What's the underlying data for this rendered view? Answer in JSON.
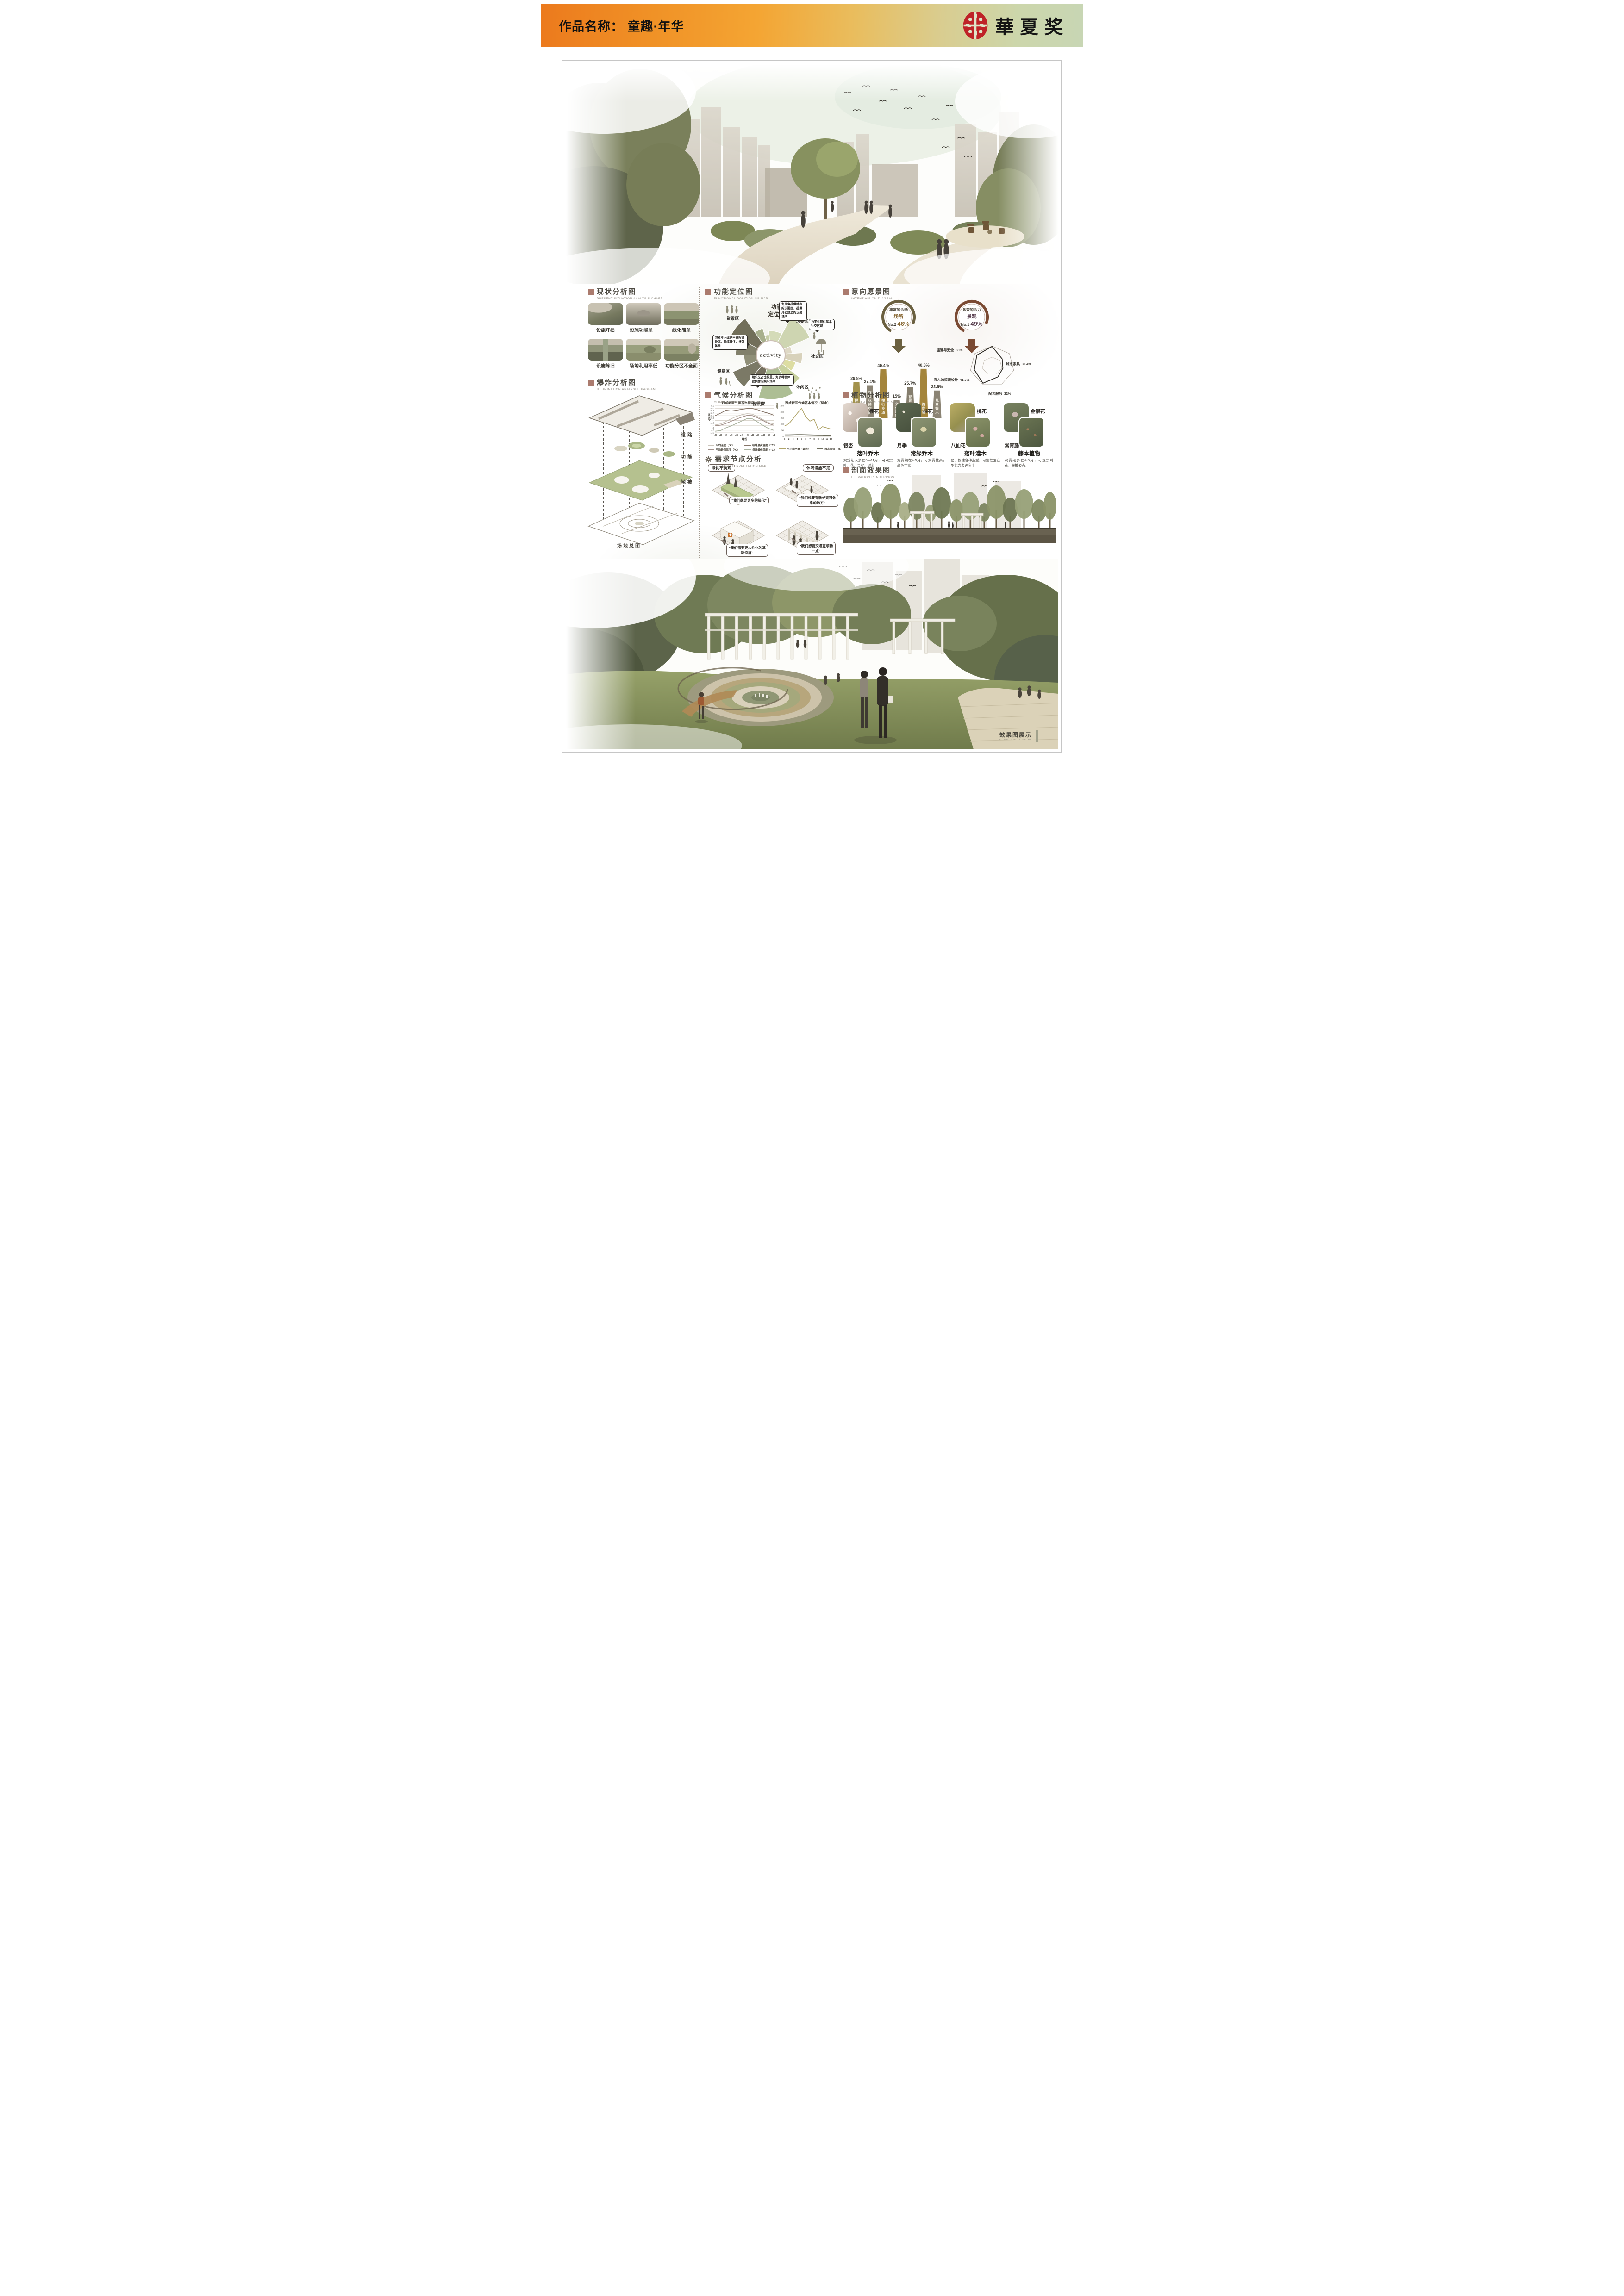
{
  "header": {
    "title": "作品名称： 童趣·年华",
    "award": "華夏奖"
  },
  "sections": {
    "present": {
      "title": "现状分析图",
      "subtitle": "PRESENT SITUATION ANALYSIS CHART",
      "photos": [
        {
          "caption": "设施坏损"
        },
        {
          "caption": "设施功能单一"
        },
        {
          "caption": "绿化简单"
        },
        {
          "caption": "设施陈旧"
        },
        {
          "caption": "场地利用率低"
        },
        {
          "caption": "功能分区不全面"
        }
      ]
    },
    "explosion": {
      "title": "爆炸分析图",
      "subtitle": "ILLUMINATION ANALYSIS DIAGRAM",
      "layers": [
        "道路",
        "功能",
        "地被"
      ],
      "base_label": "场地总图"
    },
    "functional": {
      "title": "功能定位图",
      "subtitle": "FUNCTIONAL POSITIONING MAP",
      "center_word": "activity",
      "center_title_line1": "功能",
      "center_title_line2": "定位图",
      "zones": [
        "赏景区",
        "玩耍区",
        "社交区",
        "休闲区",
        "娱乐区",
        "健身区"
      ],
      "bubbles": [
        "为儿童提供特有的玩耍区，提供开心舒适的玩耍场所",
        "为学生提供基本社交区域",
        "为老年人提供单独的健身区，锻炼身体，增强体质",
        "娱乐区占比较重，为多种群体提供休闲娱乐场所"
      ]
    },
    "climate": {
      "title": "气候分析图",
      "subtitle": "CLIMATIC ANALYSIS CHART"
    },
    "demand": {
      "title": "需求节点分析",
      "subtitle": "THEME INTERPRETATION MAP",
      "items": [
        {
          "label": "绿化不美观",
          "quote": "“我们想要更多的绿化”",
          "type": "planter"
        },
        {
          "label": "休闲设施不足",
          "quote": "“我们想要有散步完可休息的地方”",
          "type": "bench"
        },
        {
          "label": "",
          "quote": "“我们需要更人性化的基础设施”",
          "type": "kiosk"
        },
        {
          "label": "",
          "quote": "“我们想要交通更顺畅一点”",
          "type": "pergola"
        }
      ]
    },
    "intent": {
      "title": "意向愿景图",
      "subtitle": "INTENT VISION DIAGRAM",
      "circles": [
        {
          "line1": "丰富的活动",
          "line2": "场所",
          "rank": "No.2",
          "pct": "46%"
        },
        {
          "line1": "多变的活力",
          "line2": "景观",
          "rank": "No.1",
          "pct": "49%"
        }
      ]
    },
    "plants": {
      "title": "植物分析图",
      "subtitle": "PLANT ANALYSIS DIAGRAM",
      "columns": [
        {
          "top": "樱花",
          "bottom": "银杏",
          "category": "落叶乔木",
          "desc": "观赏期大多在5—11月，可观赏叶，花，果实，树姿"
        },
        {
          "top": "桂花",
          "bottom": "月季",
          "category": "常绿乔木",
          "desc": "观赏期在4-5月，可观赏性高，颜色丰富"
        },
        {
          "top": "桃花",
          "bottom": "八仙花",
          "category": "落叶灌木",
          "desc": "易于修建各种造型，可塑性强造型能力表达突出"
        },
        {
          "top": "金银花",
          "bottom": "常青藤",
          "category": "藤本植物",
          "desc": "观赏期多在4-8月，可观赏叶花，攀援姿态。"
        }
      ]
    },
    "elevation": {
      "title": "剖面效果图",
      "subtitle": "ELEVATION RENDERINGS"
    },
    "show": {
      "title": "效果图展示",
      "subtitle": "RENDERINGS SHOW"
    }
  },
  "chart_data": [
    {
      "type": "line",
      "title": "西咸新区气候基本情况（温度）",
      "xlabel": "月份",
      "ylabel": "温度℃",
      "x": [
        "1月",
        "2月",
        "3月",
        "4月",
        "5月",
        "6月",
        "7月",
        "8月",
        "9月",
        "10月",
        "11月",
        "12月"
      ],
      "ylim": [
        -10,
        45
      ],
      "ystep": 5,
      "grid": true,
      "legend_position": "bottom",
      "series": [
        {
          "name": "平均温度（℃）",
          "color": "#cbc5bb",
          "values": [
            6,
            8,
            13,
            18.5,
            23.5,
            27,
            29,
            28,
            23,
            17,
            11,
            8
          ]
        },
        {
          "name": "极端最高温度（℃）",
          "color": "#857468",
          "values": [
            25,
            30,
            36,
            34.5,
            36,
            38,
            39.5,
            39.5,
            37,
            33,
            30,
            26
          ]
        },
        {
          "name": "平均最低温度（℃）",
          "color": "#a2908a",
          "values": [
            4,
            5.5,
            9,
            13.5,
            18,
            22,
            25.5,
            25,
            20.5,
            15,
            9,
            5.5
          ]
        },
        {
          "name": "极端最低温度（℃）",
          "color": "#a9b29f",
          "values": [
            -7,
            -5.5,
            0,
            4,
            9,
            14,
            19,
            18.5,
            12,
            5,
            -1,
            -5
          ]
        }
      ]
    },
    {
      "type": "line",
      "title": "西咸新区气候基本情况（降水）",
      "x": [
        "1",
        "2",
        "3",
        "4",
        "5",
        "6",
        "7",
        "8",
        "9",
        "10",
        "11",
        "12"
      ],
      "ylim": [
        0,
        250
      ],
      "ystep": 50,
      "grid": false,
      "legend_position": "bottom",
      "series": [
        {
          "name": "平均降水量（毫米）",
          "color": "#b0a469",
          "values": [
            85,
            105,
            145,
            190,
            230,
            160,
            125,
            140,
            55,
            80,
            70,
            60
          ]
        },
        {
          "name": "降水天数（日）",
          "color": "#6e6e5e",
          "values": [
            13,
            13,
            14,
            15,
            15,
            14,
            13,
            12,
            11,
            11,
            10,
            10
          ]
        }
      ]
    },
    {
      "type": "bar",
      "title": "意向愿景活动需求占比",
      "unit": "%",
      "categories": [
        "健身运动",
        "开敞休憩空间",
        "慢行步道",
        "文化场所",
        "观景停留点",
        "跑步道",
        "儿童娱乐"
      ],
      "values": [
        29.8,
        27.1,
        40.4,
        15,
        25.7,
        40.8,
        22.8
      ],
      "colors": [
        "#a3924c",
        "#8b8474",
        "#a4853c",
        "#8b8474",
        "#857e6e",
        "#a4853c",
        "#8b8474"
      ]
    },
    {
      "type": "radar",
      "shape": "heptagon",
      "unit": "%",
      "axes_labeled": [
        {
          "label": "连通与安全",
          "value": 38
        },
        {
          "label": "城市家具",
          "value": 30.4
        },
        {
          "label": "宜人的植栽设计",
          "value": 41.7
        },
        {
          "label": "配套服务",
          "value": 32
        }
      ]
    }
  ]
}
